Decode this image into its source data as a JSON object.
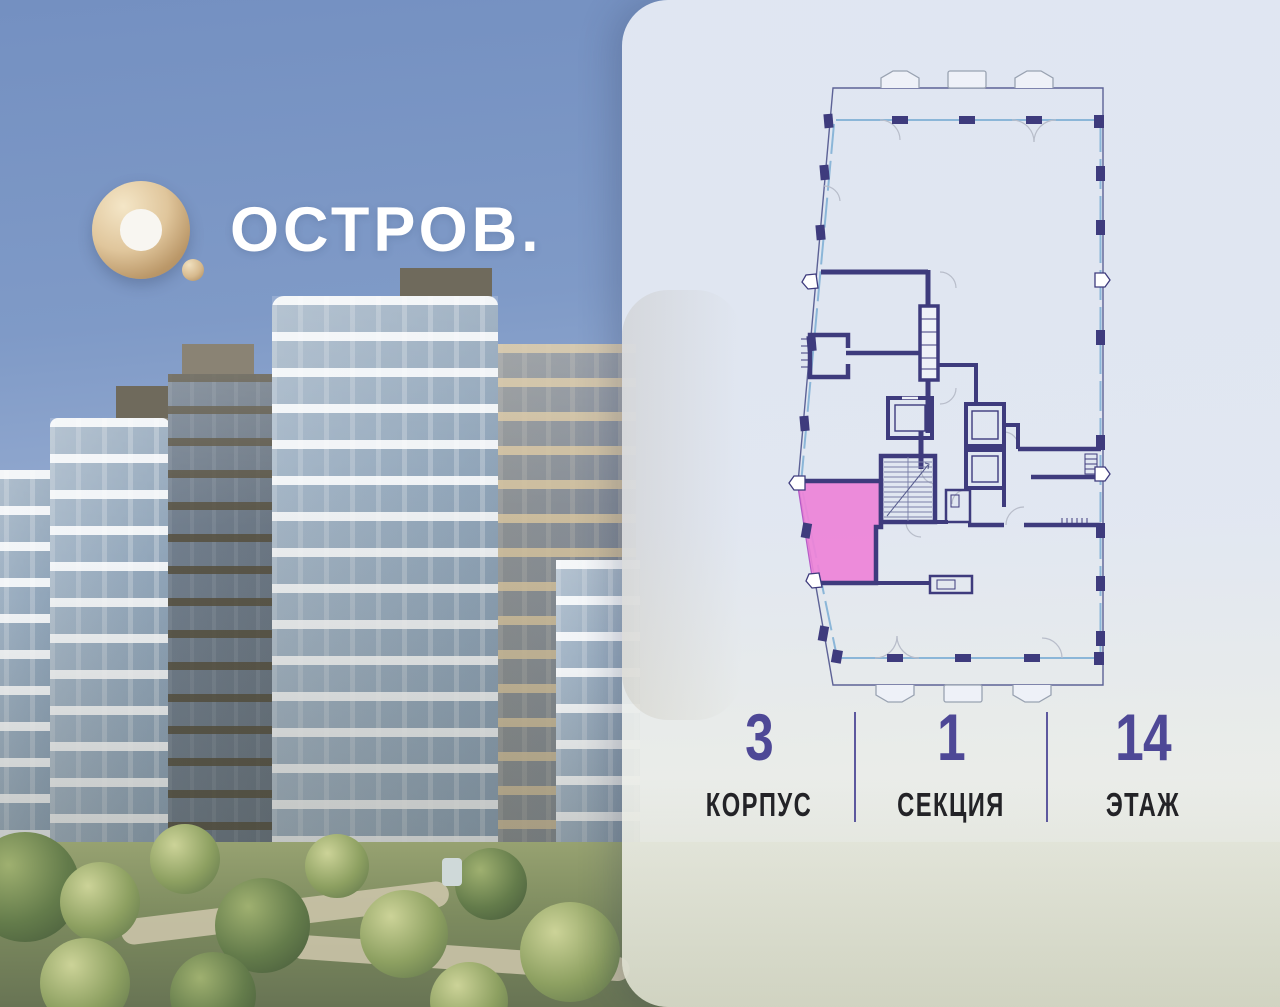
{
  "brand": {
    "name": "ОСТРОВ."
  },
  "panel": {
    "unit_info": {
      "items": [
        {
          "value": "3",
          "label": "КОРПУС"
        },
        {
          "value": "1",
          "label": "СЕКЦИЯ"
        },
        {
          "value": "14",
          "label": "ЭТАЖ"
        }
      ]
    }
  },
  "theme": {
    "accent": "#4e4896",
    "label": "#232327",
    "wall": "#3e3b7d",
    "outer": "#5d6296",
    "glazing": "#8bb6d8",
    "arc": "#b8bdca",
    "bay": "#99a2b1",
    "unit-fill": "#ee84d9",
    "unit-border": "#b351c4"
  }
}
